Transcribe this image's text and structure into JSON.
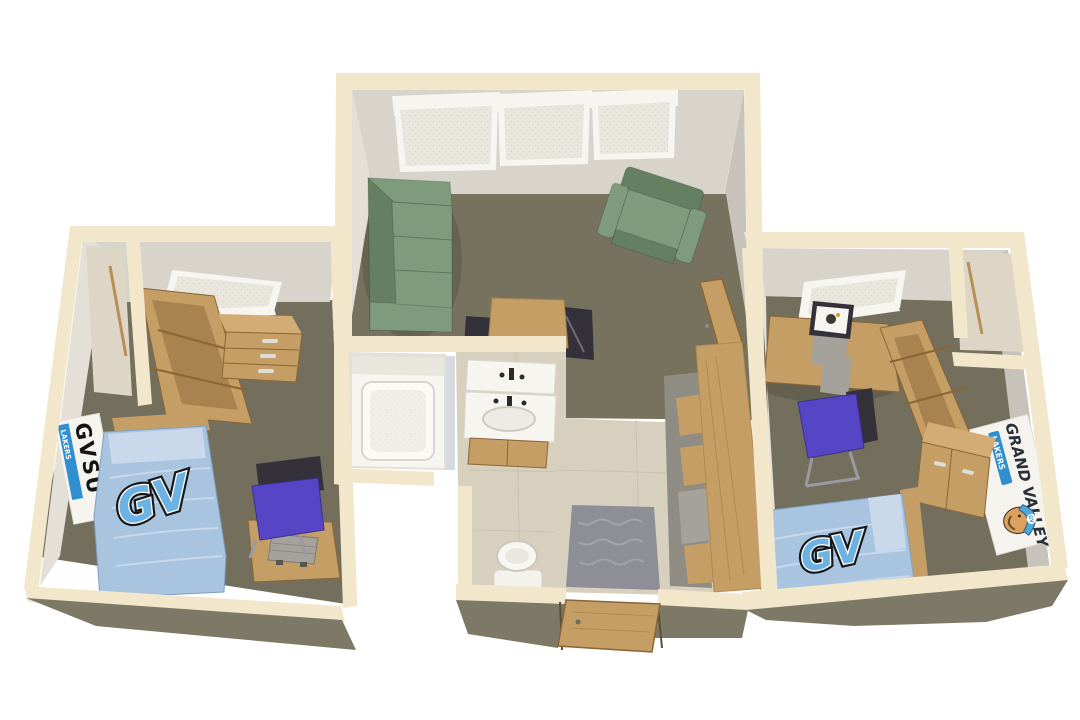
{
  "scene": {
    "title": "3D rendered floor plan of a two-bedroom university apartment",
    "rooms": [
      "bedroom-left",
      "living-room",
      "bathroom",
      "hallway",
      "bedroom-right"
    ]
  },
  "branding": {
    "poster_title": "GVSU",
    "poster_sub": "LAKERS",
    "bed_logo": "GV",
    "banner_title": "GRAND VALLEY",
    "banner_sub": "LAKERS",
    "hat_logo": "GV"
  },
  "colors": {
    "background": "#FFFFFF",
    "wall_top": "#F2E7CB",
    "wall_face_back": "#D8D4CC",
    "wall_face_lit": "#E4E0D8",
    "wall_face_shaded": "#C7C3BB",
    "wall_exterior": "#7E7966",
    "carpet": "#77725E",
    "tile": "#D8D0BF",
    "wood": "#C59E66",
    "sofa_green": "#7E9C7C",
    "bed_blue": "#A9C4DF",
    "logo_blue": "#6CB2E2",
    "chair_blue": "#5646C6",
    "rug_gray": "#8E8E96",
    "blind": "#E9E6DE"
  }
}
